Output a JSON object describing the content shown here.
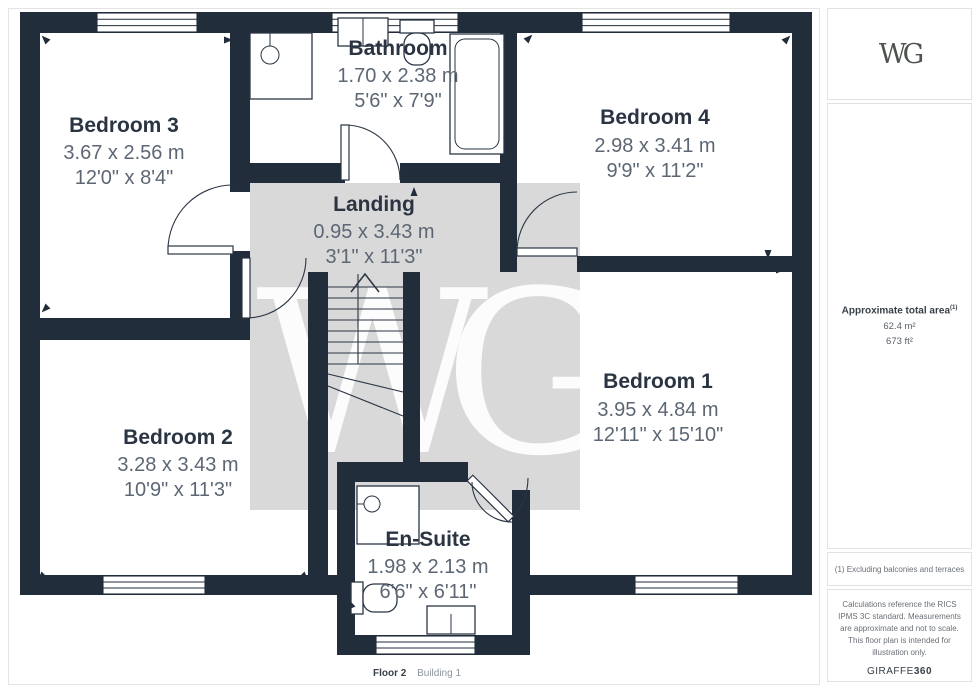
{
  "floorplan": {
    "wall_color": "#222d3b",
    "floor_color": "#ffffff",
    "room_name_color": "#2b3442",
    "dimension_color": "#5d6774",
    "watermark": {
      "text": "WG",
      "bg": "#d9d9d9",
      "fg": "#ffffff"
    },
    "rooms": [
      {
        "name": "Bedroom 3",
        "metric": "3.67 x 2.56 m",
        "imperial": "12'0\" x 8'4\""
      },
      {
        "name": "Bathroom",
        "metric": "1.70 x 2.38 m",
        "imperial": "5'6\" x 7'9\""
      },
      {
        "name": "Bedroom 4",
        "metric": "2.98 x 3.41 m",
        "imperial": "9'9\" x 11'2\""
      },
      {
        "name": "Landing",
        "metric": "0.95 x 3.43 m",
        "imperial": "3'1\" x 11'3\""
      },
      {
        "name": "Bedroom 1",
        "metric": "3.95 x 4.84 m",
        "imperial": "12'11\" x 15'10\""
      },
      {
        "name": "Bedroom 2",
        "metric": "3.28 x 3.43 m",
        "imperial": "10'9\" x 11'3\""
      },
      {
        "name": "En-Suite",
        "metric": "1.98 x 2.13 m",
        "imperial": "6'6\" x 6'11\""
      }
    ]
  },
  "sidebar": {
    "logo": "WG",
    "area": {
      "label": "Approximate total area",
      "superscript": "(1)",
      "metric": "62.4 m²",
      "imperial": "673 ft²"
    },
    "footnote": "(1) Excluding balconies and terraces",
    "disclaimer": "Calculations reference the RICS IPMS 3C standard. Measurements are approximate and not to scale. This floor plan is intended for illustration only.",
    "brand": {
      "name": "GIRAFFE",
      "suffix": "360"
    }
  },
  "footer": {
    "floor": "Floor 2",
    "building": "Building 1"
  }
}
